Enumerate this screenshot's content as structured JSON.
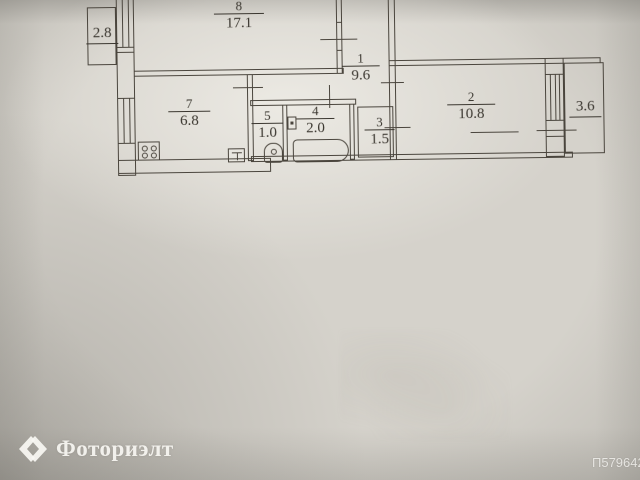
{
  "photo_id": "П579642",
  "watermark": {
    "brand": "Фоториэлт",
    "logo_icon": "diamond-chevrons-icon"
  },
  "plan": {
    "type": "apartment-floor-plan",
    "rooms": [
      {
        "number": "8",
        "area": "17.1"
      },
      {
        "number": "1",
        "area": "9.6"
      },
      {
        "number": "7",
        "area": "6.8"
      },
      {
        "number": "5",
        "area": "1.0"
      },
      {
        "number": "4",
        "area": "2.0"
      },
      {
        "number": "3",
        "area": "1.5"
      },
      {
        "number": "2",
        "area": "10.8"
      }
    ],
    "balconies": [
      {
        "area": "2.8"
      },
      {
        "area": "3.6"
      }
    ],
    "fixtures": [
      "stove-icon",
      "toilet-icon",
      "bathtub-icon",
      "sink-icon",
      "vent-icon"
    ]
  },
  "colors": {
    "paper": "#d5d2cb",
    "ink": "#4a453d",
    "watermark": "#f4f3ef"
  }
}
